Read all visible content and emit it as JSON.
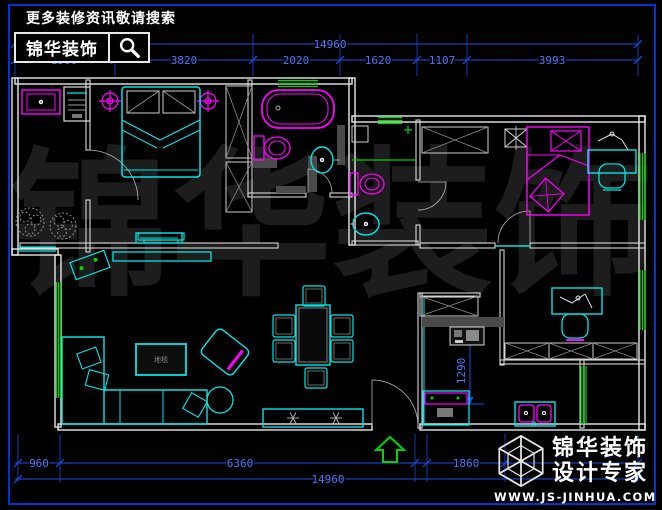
{
  "banner": {
    "tagline": "更多装修资讯敬请搜索",
    "brand": "锦华装饰"
  },
  "watermark": {
    "chars": [
      "锦",
      "华",
      "装",
      "饰"
    ]
  },
  "dimensions": {
    "top_total": "14960",
    "top_segments": [
      "1560",
      "3820",
      "2020",
      "1620",
      "1107",
      "3993"
    ],
    "bottom_segments": [
      "960",
      "6360",
      "1860"
    ],
    "bottom_total": "14960",
    "kitchen_vertical": "1290"
  },
  "plan_labels": {
    "rug": "地毯"
  },
  "footer": {
    "brand": "锦华装饰",
    "subtitle": "设计专家",
    "website": "WWW.JS-JINHUA.COM"
  },
  "colors": {
    "background": "#000000",
    "frame_blue": "#0034cf",
    "dimension_blue": "#1a4fe0",
    "dimension_text": "#4b79ff",
    "wall_white": "#e8e8e8",
    "furniture_cyan": "#00e5e5",
    "fixture_magenta": "#ff00ff",
    "window_green": "#00d400",
    "watermark_gray": "#1d1d1d"
  }
}
